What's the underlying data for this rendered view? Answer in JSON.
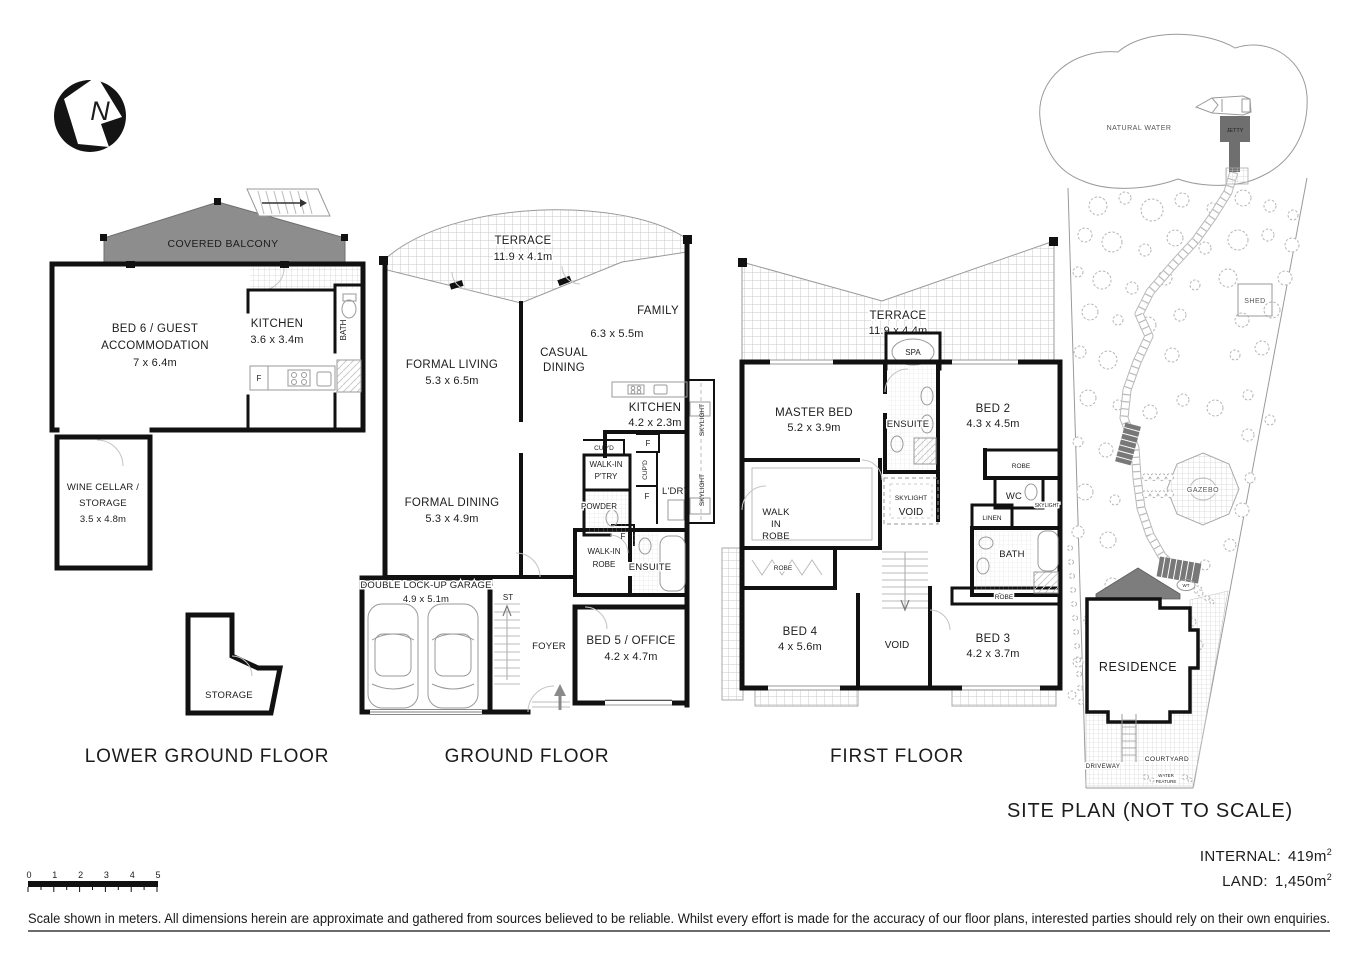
{
  "compass": {
    "letter": "N"
  },
  "lower_ground": {
    "title": "LOWER GROUND FLOOR",
    "covered_balcony": "COVERED BALCONY",
    "bed6_line1": "BED 6 / GUEST",
    "bed6_line2": "ACCOMMODATION",
    "bed6_dim": "7 x 6.4m",
    "kitchen": "KITCHEN",
    "kitchen_dim": "3.6 x 3.4m",
    "bath": "BATH",
    "fridge": "F",
    "wine_line1": "WINE CELLAR /",
    "wine_line2": "STORAGE",
    "wine_dim": "3.5 x 4.8m",
    "storage": "STORAGE"
  },
  "ground": {
    "title": "GROUND FLOOR",
    "terrace": "TERRACE",
    "terrace_dim": "11.9 x 4.1m",
    "formal_living": "FORMAL LIVING",
    "formal_living_dim": "5.3 x 6.5m",
    "casual_dining_line1": "CASUAL",
    "casual_dining_line2": "DINING",
    "family": "FAMILY",
    "family_dim": "6.3 x 5.5m",
    "kitchen": "KITCHEN",
    "kitchen_dim": "4.2 x 2.3m",
    "skylight_top": "SKYLIGHT",
    "skylight_bottom": "SKYLIGHT",
    "cupboard_top": "CUP'D",
    "pantry_line1": "WALK-IN",
    "pantry_line2": "P'TRY",
    "powder": "POWDER",
    "cupboard_side": "CUP'D",
    "fridge1": "F",
    "fridge2": "F",
    "fridge3": "F",
    "laundry": "L'DRY",
    "formal_dining": "FORMAL DINING",
    "formal_dining_dim": "5.3 x 4.9m",
    "walk_in_robe_line1": "WALK-IN",
    "walk_in_robe_line2": "ROBE",
    "ensuite": "ENSUITE",
    "garage": "DOUBLE LOCK-UP GARAGE",
    "garage_dim": "4.9 x 5.1m",
    "stairs": "ST",
    "foyer": "FOYER",
    "bed5": "BED 5 / OFFICE",
    "bed5_dim": "4.2 x 4.7m"
  },
  "first": {
    "title": "FIRST FLOOR",
    "terrace": "TERRACE",
    "terrace_dim": "11.9 x 4.4m",
    "spa": "SPA",
    "master_bed": "MASTER BED",
    "master_bed_dim": "5.2 x 3.9m",
    "ensuite": "ENSUITE",
    "bed2": "BED 2",
    "bed2_dim": "4.3 x 4.5m",
    "robe_bed2": "ROBE",
    "wc": "WC",
    "skylight_small": "SKYLIGHT",
    "skylight_void_line1": "SKYLIGHT",
    "skylight_void_line2": "VOID",
    "linen": "LINEN",
    "bath": "BATH",
    "walk_in_robe_line1": "WALK",
    "walk_in_robe_line2": "IN",
    "walk_in_robe_line3": "ROBE",
    "robe_bed4": "ROBE",
    "robe_bed3": "ROBE",
    "bed4": "BED 4",
    "bed4_dim": "4 x 5.6m",
    "void": "VOID",
    "bed3": "BED 3",
    "bed3_dim": "4.2 x 3.7m"
  },
  "site": {
    "title": "SITE PLAN (NOT TO SCALE)",
    "natural_water": "NATURAL WATER",
    "jetty": "JETTY",
    "shed": "SHED",
    "gazebo": "GAZEBO",
    "residence": "RESIDENCE",
    "driveway": "DRIVEWAY",
    "courtyard": "COURTYARD",
    "water_feature_line1": "WATER",
    "water_feature_line2": "FEATURE",
    "water_tank": "WT"
  },
  "footer": {
    "scale_ticks": [
      "0",
      "1",
      "2",
      "3",
      "4",
      "5"
    ],
    "internal_label": "INTERNAL:",
    "internal_value": "419m",
    "internal_sup": "2",
    "land_label": "LAND:",
    "land_value": "1,450m",
    "land_sup": "2",
    "disclaimer": "Scale shown in meters. All dimensions herein are approximate and gathered from sources believed to be reliable. Whilst every effort is made for the accuracy of our floor plans, interested parties should rely on their own enquiries."
  },
  "colors": {
    "wall": "#111111",
    "balcony_gray": "#8d8d8d",
    "jetty_gray": "#6f6f6f",
    "roof_gray": "#7d7d7d",
    "stair_gray": "#787878"
  }
}
